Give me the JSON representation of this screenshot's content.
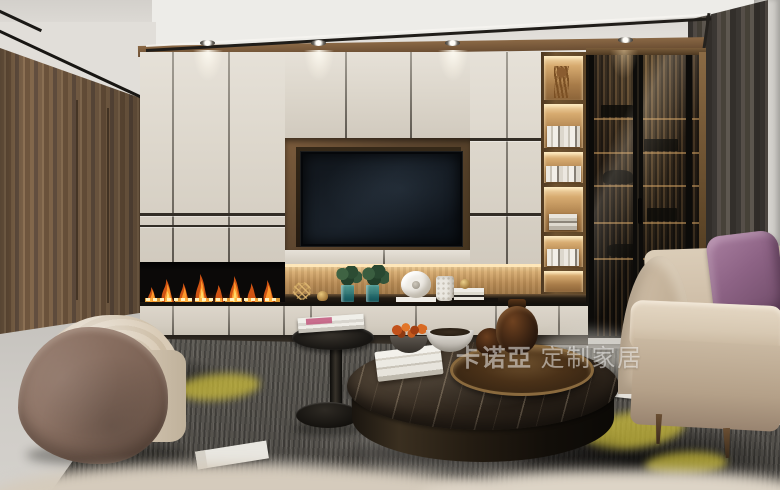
{
  "watermark": {
    "brand": "卡诺亞",
    "suffix": "定制家居",
    "full_text": "卡诺亞 定制家居",
    "color": "#ffffff",
    "opacity": 0.5
  },
  "scene": {
    "type": "interior-3d-render",
    "room": "living-room",
    "style": "modern custom cabinetry showroom",
    "objects": [
      {
        "name": "tray-ceiling",
        "desc": "white stepped tray ceiling with black reveal trim"
      },
      {
        "name": "recessed-downlights",
        "count": 4
      },
      {
        "name": "walnut-wall-panel",
        "desc": "vertical-grain walnut panel wall, left side"
      },
      {
        "name": "white-cabinet-wall",
        "desc": "floor-to-ceiling matte cream lacquer cabinets with dark grooves"
      },
      {
        "name": "tv",
        "desc": "wall-mounted flat TV in dark walnut recess, screen off"
      },
      {
        "name": "linear-fireplace",
        "desc": "built-in linear fireplace with flames and glowing coal bed"
      },
      {
        "name": "decor-niche",
        "desc": "LED-lit wood niche with green plants in teal glass vases, white faceted sculpture, studded vase, books, gold wire ornament"
      },
      {
        "name": "open-bookshelf",
        "desc": "LED-lit walnut shelving column with books and twig decor"
      },
      {
        "name": "glass-display-cabinet",
        "desc": "smoked-glass sliding-door cabinet, black frames, lit wood interior with book silhouettes"
      },
      {
        "name": "curtain",
        "desc": "dark gray floor curtain"
      },
      {
        "name": "sheer-curtain",
        "desc": "white sheer at right edge"
      },
      {
        "name": "cream-sofa",
        "desc": "beige fabric sofa with curved arm and wooden legs"
      },
      {
        "name": "purple-pillow",
        "desc": "mauve velvet cushion on sofa"
      },
      {
        "name": "taupe-pillow",
        "desc": "small taupe cushion at right edge"
      },
      {
        "name": "barrel-armchair",
        "desc": "curved armchair, brown suede shell, cream onyx-pattern upholstery"
      },
      {
        "name": "marble-coffee-table",
        "desc": "round dark emperador marble drum table"
      },
      {
        "name": "bronze-tray",
        "desc": "round bronze tray with dark amber vases"
      },
      {
        "name": "white-book-stack",
        "desc": "stack of white books on table"
      },
      {
        "name": "flower-bowl",
        "desc": "dark bowl with rust-orange flowers"
      },
      {
        "name": "marble-bowl",
        "desc": "white marble bowl with dark potpourri"
      },
      {
        "name": "pedestal-side-table",
        "desc": "black round pedestal side table with magazines"
      },
      {
        "name": "area-rug",
        "desc": "abstract charcoal/gray rug with yellow accents"
      },
      {
        "name": "marble-floor",
        "desc": "light gray marble floor"
      },
      {
        "name": "foreground-blur",
        "desc": "out-of-focus cream sofa back across bottom edge"
      }
    ]
  },
  "palette": {
    "ceiling": "#e9e6e1",
    "cabinet_cream": "#ded8cd",
    "walnut": "#7d6348",
    "niche_wood_lit": "#d8ad72",
    "tv_screen": "#10151b",
    "flame_orange": "#ff9d2e",
    "flame_core": "#ffe08a",
    "glass_cabinet": "#241d15",
    "curtain_gray": "#4a4540",
    "sofa_cream": "#d4c4ae",
    "pillow_purple": "#8d6385",
    "armchair_brown": "#86695b",
    "rug_charcoal": "#55524d",
    "rug_yellow": "#c9ba3a",
    "floor_marble": "#c9c6c1",
    "table_marble": "#362b20",
    "bronze": "#8a6a3e"
  }
}
